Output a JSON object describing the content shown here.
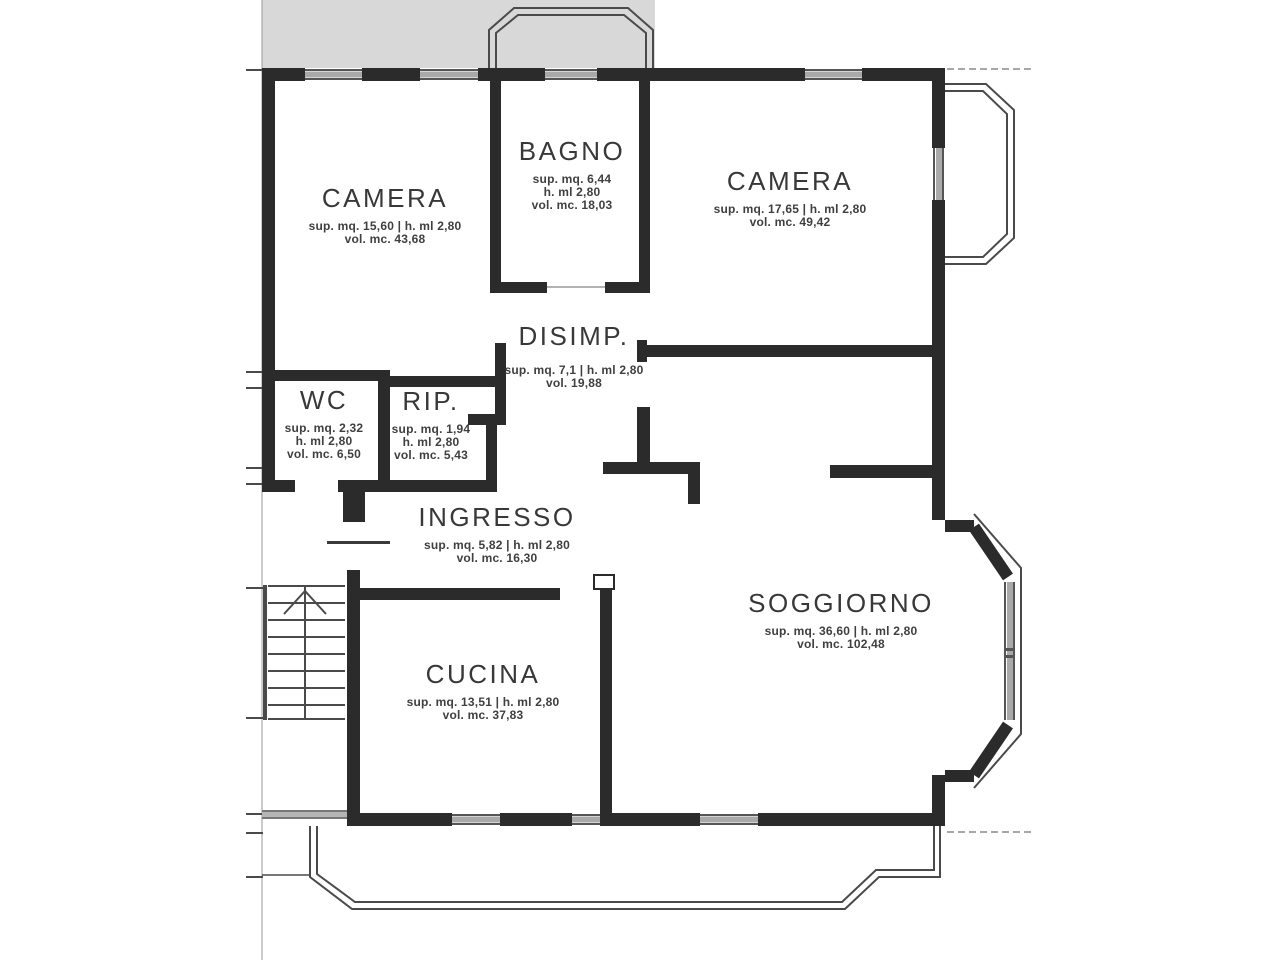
{
  "drawing": {
    "type": "apartment-floor-plan",
    "language": "it"
  },
  "colors": {
    "wall": "#2b2b2b",
    "thin_line": "#4a4a4a",
    "terrace_fill": "#d8d8d8",
    "window_gray": "#a9a9a9",
    "dashed_line": "#8a8a8a",
    "text": "#3f3f3f"
  },
  "rooms": [
    {
      "name": "CAMERA",
      "line1": "sup. mq. 15,60 | h. ml 2,80",
      "line2": "vol. mc. 43,68",
      "line3": ""
    },
    {
      "name": "BAGNO",
      "line1": "sup. mq. 6,44",
      "line2": "h. ml 2,80",
      "line3": "vol. mc. 18,03"
    },
    {
      "name": "CAMERA",
      "line1": "sup. mq. 17,65 | h. ml 2,80",
      "line2": "vol. mc. 49,42",
      "line3": ""
    },
    {
      "name": "DISIMP.",
      "line1": "sup. mq. 7,1 | h. ml 2,80",
      "line2": "vol. 19,88",
      "line3": ""
    },
    {
      "name": "WC",
      "line1": "sup. mq. 2,32",
      "line2": "h. ml 2,80",
      "line3": "vol. mc. 6,50"
    },
    {
      "name": "RIP.",
      "line1": "sup. mq. 1,94",
      "line2": "h. ml 2,80",
      "line3": "vol. mc. 5,43"
    },
    {
      "name": "INGRESSO",
      "line1": "sup. mq. 5,82 | h. ml 2,80",
      "line2": "vol. mc. 16,30",
      "line3": ""
    },
    {
      "name": "CUCINA",
      "line1": "sup. mq. 13,51 | h. ml 2,80",
      "line2": "vol. mc. 37,83",
      "line3": ""
    },
    {
      "name": "SOGGIORNO",
      "line1": "sup. mq. 36,60 | h. ml 2,80",
      "line2": "vol. mc. 102,48",
      "line3": ""
    }
  ]
}
